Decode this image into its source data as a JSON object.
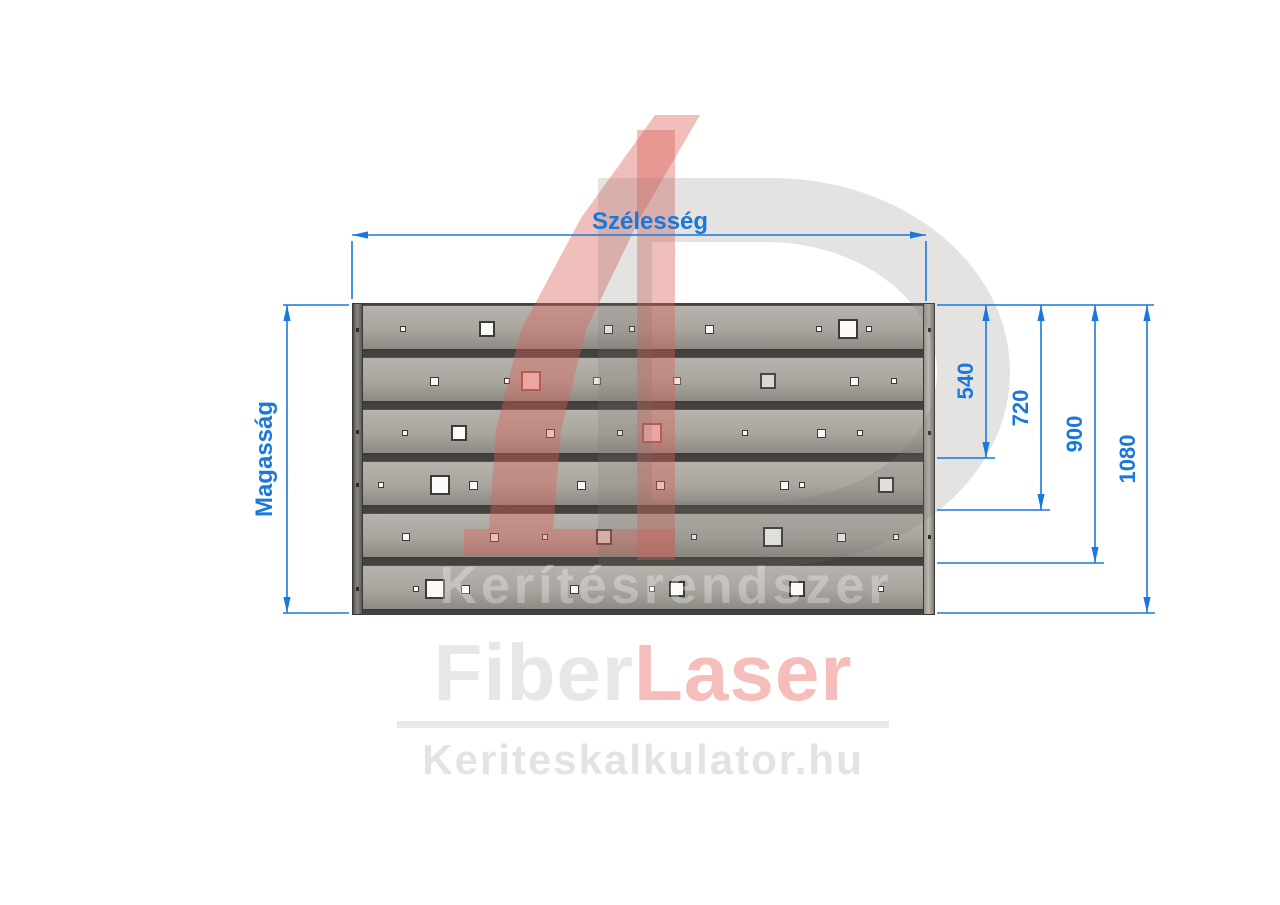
{
  "dimension_labels": {
    "width": "Szélesség",
    "height": "Magasság"
  },
  "right_dimensions": [
    "540",
    "720",
    "900",
    "1080"
  ],
  "watermark": {
    "numeral": "4",
    "letter": "D",
    "text": "Kerítésrendszer"
  },
  "logo": {
    "gray_part": "Fiber",
    "red_part": "Laser",
    "website": "Keriteskalkulator.hu"
  },
  "colors": {
    "dimension_blue": "#1878dc",
    "board_gray": "#a7a49e",
    "gap_dark": "#444240",
    "watermark_red": "rgba(219,95,85,0.40)",
    "watermark_gray": "rgba(122,117,110,0.20)",
    "logo_gray": "#e7e7e7",
    "logo_red": "#f6beba",
    "bar_gray": "#e9e9e9",
    "site_gray": "#e3e3e3",
    "hole_fills": {
      "w": "#fbfaf8",
      "p": "#f6d6d6",
      "lp": "#f3e2df",
      "g": "#dbd8d3"
    },
    "hole_borders": {
      "w": "#3c3a37",
      "p": "#9b5a54",
      "lp": "#6b5a55",
      "g": "#4a4845"
    }
  },
  "panel": {
    "board_count": 6,
    "left_post_rivets_y": [
      330,
      432,
      485,
      589
    ],
    "right_post_rivets_y": [
      330,
      433,
      537
    ],
    "holes": [
      [
        1,
        403,
        4,
        "w"
      ],
      [
        1,
        487,
        12,
        "w"
      ],
      [
        1,
        608,
        7,
        "w"
      ],
      [
        1,
        632,
        4,
        "w"
      ],
      [
        1,
        709,
        7,
        "w"
      ],
      [
        1,
        819,
        4,
        "w"
      ],
      [
        1,
        848,
        16,
        "w"
      ],
      [
        1,
        869,
        4,
        "w"
      ],
      [
        2,
        434,
        7,
        "w"
      ],
      [
        2,
        507,
        4,
        "w"
      ],
      [
        2,
        531,
        16,
        "p"
      ],
      [
        2,
        597,
        6,
        "lp"
      ],
      [
        2,
        677,
        6,
        "lp"
      ],
      [
        2,
        768,
        12,
        "g"
      ],
      [
        2,
        854,
        7,
        "w"
      ],
      [
        2,
        894,
        4,
        "w"
      ],
      [
        3,
        405,
        4,
        "w"
      ],
      [
        3,
        459,
        12,
        "w"
      ],
      [
        3,
        550,
        7,
        "w"
      ],
      [
        3,
        620,
        4,
        "w"
      ],
      [
        3,
        652,
        16,
        "p"
      ],
      [
        3,
        745,
        4,
        "w"
      ],
      [
        3,
        821,
        7,
        "w"
      ],
      [
        3,
        860,
        4,
        "w"
      ],
      [
        4,
        381,
        4,
        "w"
      ],
      [
        4,
        440,
        16,
        "w"
      ],
      [
        4,
        473,
        7,
        "w"
      ],
      [
        4,
        581,
        7,
        "w"
      ],
      [
        4,
        660,
        7,
        "w"
      ],
      [
        4,
        784,
        7,
        "w"
      ],
      [
        4,
        802,
        4,
        "w"
      ],
      [
        4,
        886,
        12,
        "w"
      ],
      [
        5,
        406,
        6,
        "w"
      ],
      [
        5,
        494,
        7,
        "w"
      ],
      [
        5,
        545,
        4,
        "w"
      ],
      [
        5,
        604,
        12,
        "w"
      ],
      [
        5,
        694,
        4,
        "w"
      ],
      [
        5,
        773,
        16,
        "w"
      ],
      [
        5,
        841,
        7,
        "w"
      ],
      [
        5,
        896,
        4,
        "w"
      ],
      [
        6,
        416,
        4,
        "w"
      ],
      [
        6,
        435,
        16,
        "w"
      ],
      [
        6,
        465,
        7,
        "w"
      ],
      [
        6,
        574,
        7,
        "w"
      ],
      [
        6,
        652,
        4,
        "w"
      ],
      [
        6,
        677,
        12,
        "w"
      ],
      [
        6,
        797,
        12,
        "w"
      ],
      [
        6,
        881,
        4,
        "w"
      ]
    ]
  }
}
